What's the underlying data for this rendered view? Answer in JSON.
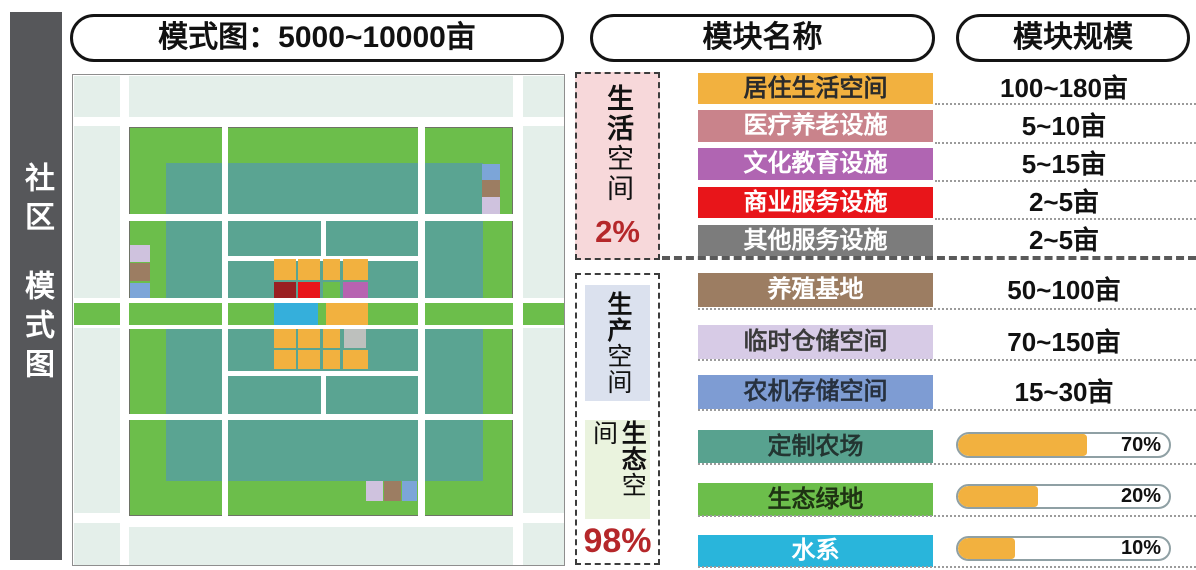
{
  "sidebar": {
    "part1": "社区",
    "part2": "模式图"
  },
  "headers": {
    "pattern": "模式图：5000~10000亩",
    "module_name": "模块名称",
    "module_scale": "模块规模"
  },
  "groups": {
    "life": {
      "bold": "生活",
      "rest": "空间",
      "percent": "2%"
    },
    "production": {
      "bold": "生产",
      "rest": "空间"
    },
    "ecology": {
      "bold": "生态",
      "rest": "空间"
    },
    "prod_eco_percent": "98%"
  },
  "modules": [
    {
      "label": "居住生活空间",
      "value": "100~180亩",
      "color": "#F2B13F",
      "text": "#2b2b2b"
    },
    {
      "label": "医疗养老设施",
      "value": "5~10亩",
      "color": "#C9838B",
      "text": "#ffffff"
    },
    {
      "label": "文化教育设施",
      "value": "5~15亩",
      "color": "#B065B2",
      "text": "#ffffff"
    },
    {
      "label": "商业服务设施",
      "value": "2~5亩",
      "color": "#E8151A",
      "text": "#ffffff"
    },
    {
      "label": "其他服务设施",
      "value": "2~5亩",
      "color": "#7C7C7C",
      "text": "#ffffff"
    },
    {
      "label": "养殖基地",
      "value": "50~100亩",
      "color": "#9C7D62",
      "text": "#ffffff"
    },
    {
      "label": "临时仓储空间",
      "value": "70~150亩",
      "color": "#D7CBE6",
      "text": "#3a3a3a"
    },
    {
      "label": "农机存储空间",
      "value": "15~30亩",
      "color": "#7E9CD3",
      "text": "#27313f"
    },
    {
      "label": "定制农场",
      "percent": "70%",
      "fill": "61%",
      "color": "#58A28F",
      "text": "#233531"
    },
    {
      "label": "生态绿地",
      "percent": "20%",
      "fill": "38%",
      "color": "#6CBE4B",
      "text": "#1e3313"
    },
    {
      "label": "水系",
      "percent": "10%",
      "fill": "27%",
      "color": "#29B5DB",
      "text": "#ffffff"
    }
  ],
  "palette": {
    "pale": "#E4EFEA",
    "green": "#6CBE4B",
    "teal": "#5AA492",
    "yellow": "#F2B13F",
    "darkred": "#9A2022",
    "red": "#E8151A",
    "magenta": "#B763B1",
    "water": "#35AFDB",
    "grayblock": "#BDC0BD",
    "brown": "#9C7D62",
    "lavender": "#CFC2DE",
    "smallblue": "#7CA5D8",
    "sidebar": "#56575A",
    "pinkbg": "#F7D8DA",
    "bluegraybg": "#DBE1EE",
    "palegreenbg": "#EAF3DE",
    "pctred": "#B5272A"
  },
  "map": {
    "blocks": [
      {
        "x": 201,
        "y": 184,
        "w": 22,
        "h": 21,
        "c": "yellow"
      },
      {
        "x": 225,
        "y": 184,
        "w": 22,
        "h": 21,
        "c": "yellow"
      },
      {
        "x": 250,
        "y": 184,
        "w": 17,
        "h": 21,
        "c": "yellow"
      },
      {
        "x": 270,
        "y": 184,
        "w": 25,
        "h": 21,
        "c": "yellow"
      },
      {
        "x": 201,
        "y": 207,
        "w": 22,
        "h": 16,
        "c": "darkred"
      },
      {
        "x": 225,
        "y": 207,
        "w": 22,
        "h": 16,
        "c": "red"
      },
      {
        "x": 250,
        "y": 207,
        "w": 17,
        "h": 16,
        "c": "green"
      },
      {
        "x": 270,
        "y": 207,
        "w": 25,
        "h": 16,
        "c": "magenta"
      },
      {
        "x": 201,
        "y": 228,
        "w": 44,
        "h": 22,
        "c": "water"
      },
      {
        "x": 253,
        "y": 228,
        "w": 42,
        "h": 22,
        "c": "yellow"
      },
      {
        "x": 201,
        "y": 254,
        "w": 22,
        "h": 19,
        "c": "yellow"
      },
      {
        "x": 225,
        "y": 254,
        "w": 22,
        "h": 19,
        "c": "yellow"
      },
      {
        "x": 250,
        "y": 254,
        "w": 17,
        "h": 19,
        "c": "yellow"
      },
      {
        "x": 271,
        "y": 254,
        "w": 22,
        "h": 19,
        "c": "grayblock"
      },
      {
        "x": 201,
        "y": 275,
        "w": 22,
        "h": 19,
        "c": "yellow"
      },
      {
        "x": 225,
        "y": 275,
        "w": 22,
        "h": 19,
        "c": "yellow"
      },
      {
        "x": 250,
        "y": 275,
        "w": 17,
        "h": 19,
        "c": "yellow"
      },
      {
        "x": 270,
        "y": 275,
        "w": 25,
        "h": 19,
        "c": "yellow"
      },
      {
        "x": 409,
        "y": 89,
        "w": 18,
        "h": 16,
        "c": "smallblue"
      },
      {
        "x": 409,
        "y": 105,
        "w": 18,
        "h": 17,
        "c": "brown"
      },
      {
        "x": 409,
        "y": 122,
        "w": 18,
        "h": 17,
        "c": "lavender"
      },
      {
        "x": 57,
        "y": 170,
        "w": 20,
        "h": 17,
        "c": "lavender"
      },
      {
        "x": 57,
        "y": 188,
        "w": 20,
        "h": 18,
        "c": "brown"
      },
      {
        "x": 57,
        "y": 208,
        "w": 20,
        "h": 15,
        "c": "smallblue"
      },
      {
        "x": 293,
        "y": 406,
        "w": 17,
        "h": 20,
        "c": "lavender"
      },
      {
        "x": 311,
        "y": 406,
        "w": 17,
        "h": 20,
        "c": "brown"
      },
      {
        "x": 329,
        "y": 406,
        "w": 15,
        "h": 20,
        "c": "smallblue"
      }
    ]
  }
}
